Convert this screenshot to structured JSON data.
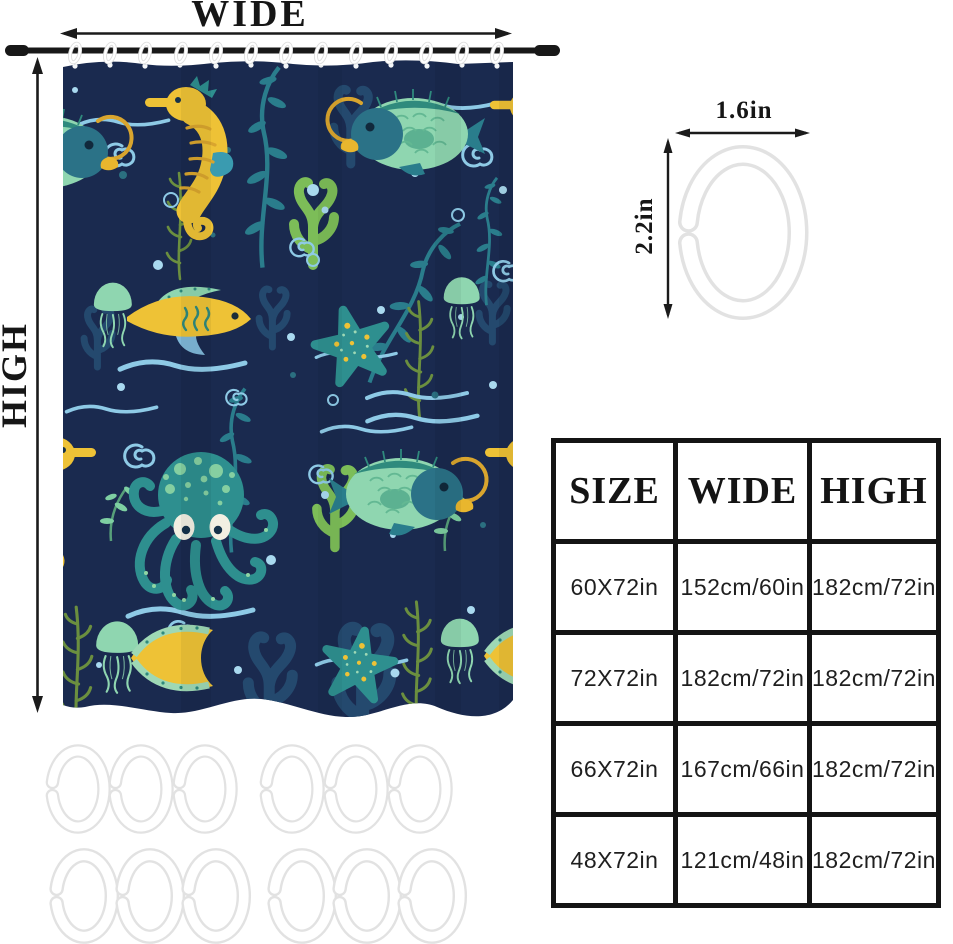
{
  "dimension_labels": {
    "width": "WIDE",
    "height": "HIGH"
  },
  "hook_diagram": {
    "width_label": "1.6in",
    "height_label": "2.2in"
  },
  "size_table": {
    "headers": [
      "SIZE",
      "WIDE",
      "HIGH"
    ],
    "rows": [
      {
        "size": "60X72in",
        "wide": "152cm/60in",
        "high": "182cm/72in"
      },
      {
        "size": "72X72in",
        "wide": "182cm/72in",
        "high": "182cm/72in"
      },
      {
        "size": "66X72in",
        "wide": "167cm/66in",
        "high": "182cm/72in"
      },
      {
        "size": "48X72in",
        "wide": "121cm/48in",
        "high": "182cm/72in"
      }
    ]
  },
  "colors": {
    "curtain_navy": "#1a2a4f",
    "rod_black": "#181818",
    "arrow_black": "#1b1b1b",
    "accent_yellow": "#eec236",
    "teal": "#2e8f8f",
    "mint_green": "#8fd6b0",
    "light_blue": "#8ecae6",
    "leaf_green": "#7cbd58",
    "olive_green": "#6b8f3f",
    "hook_white": "#ffffff",
    "hook_outline": "#e2e2e2",
    "table_border": "#141414"
  }
}
